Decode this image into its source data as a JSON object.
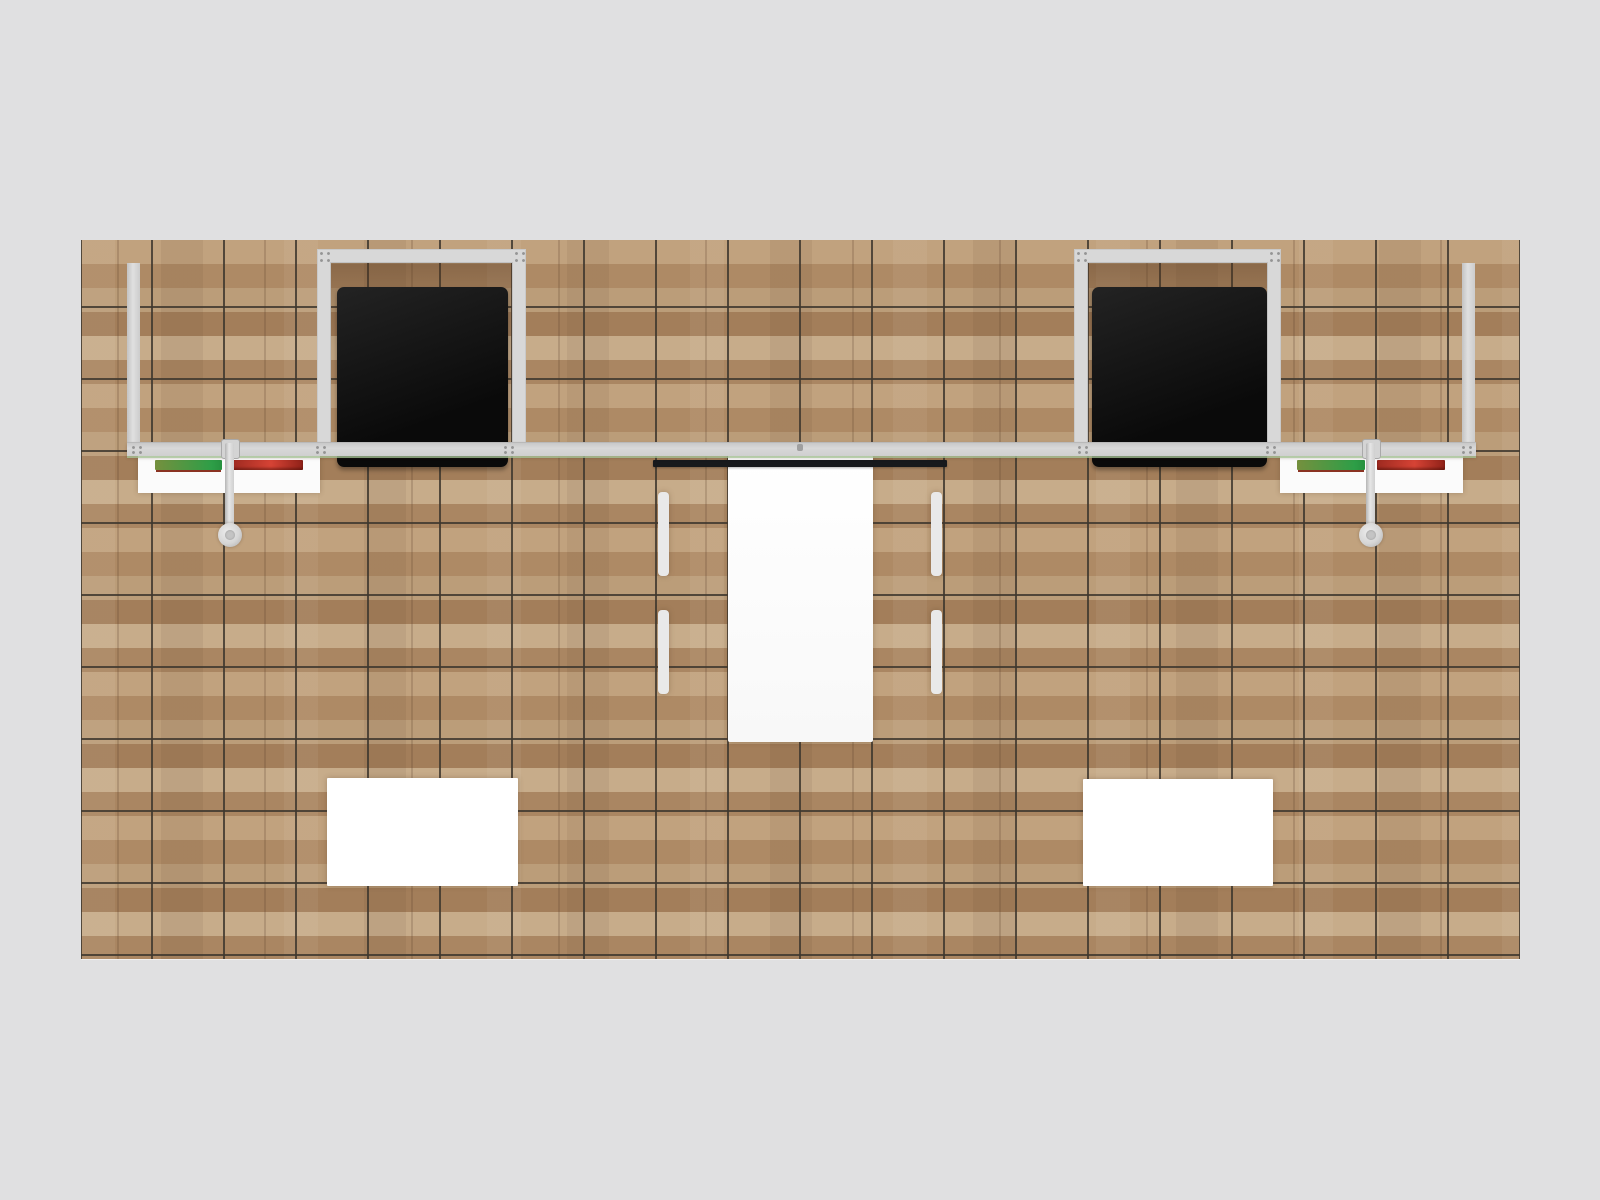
{
  "scene": {
    "type": "3d-render-top-view",
    "subject": "inline trade show exhibit booth on wood plank flooring",
    "background_color": "#e0e0e1"
  },
  "floor": {
    "base_color": "#b5946f",
    "plank_colors": [
      "#c1a27e",
      "#ae8a65",
      "#bb9d79",
      "#a37e5a",
      "#c7ac8a",
      "#aa8662"
    ],
    "grid_line_color": "#3e3830",
    "grid_cell_px": 72
  },
  "structure": {
    "frame_color": "#d8d8d8",
    "frame_edge_color": "#b9b9b9",
    "accent_line_color": "#a9c89b",
    "monitor_color_start": "#232323",
    "monitor_color_end": "#0a0a0a",
    "hanging_bar_color": "#17191c",
    "monitor_count": 2,
    "labels": {
      "backwall_beam": "backwall top beam",
      "left_endcap": "left sidewall panel",
      "right_endcap": "right sidewall panel",
      "left_frame": "left monitor mount frame",
      "right_frame": "right monitor mount frame",
      "left_monitor": "left flat screen",
      "right_monitor": "right flat screen",
      "hanging_bar": "center header bar"
    }
  },
  "furniture": {
    "counter_color": "#fbfbfb",
    "table_color": "#f8f8f8",
    "chair_color": "#ffffff",
    "chair_back_color": "#e9e9e9",
    "chair_count": 4,
    "pedestal_color": "#ffffff",
    "pole_color": "#cfcfcf",
    "disc_color": "#d6d6d6",
    "strip_green_start": "#75903e",
    "strip_green_end": "#2d9e47",
    "strip_green_underline": "#8a3322",
    "strip_red_start": "#9e2a20",
    "strip_red_mid": "#d64335",
    "strip_red_end": "#8f2118",
    "labels": {
      "left_counter": "left literature counter",
      "right_counter": "right literature counter",
      "meeting_table": "meeting table",
      "chairs": "four white chairs",
      "left_pedestal": "left white pedestal",
      "right_pedestal": "right white pedestal",
      "left_stand": "left tablet stand arm",
      "right_stand": "right tablet stand arm"
    }
  }
}
